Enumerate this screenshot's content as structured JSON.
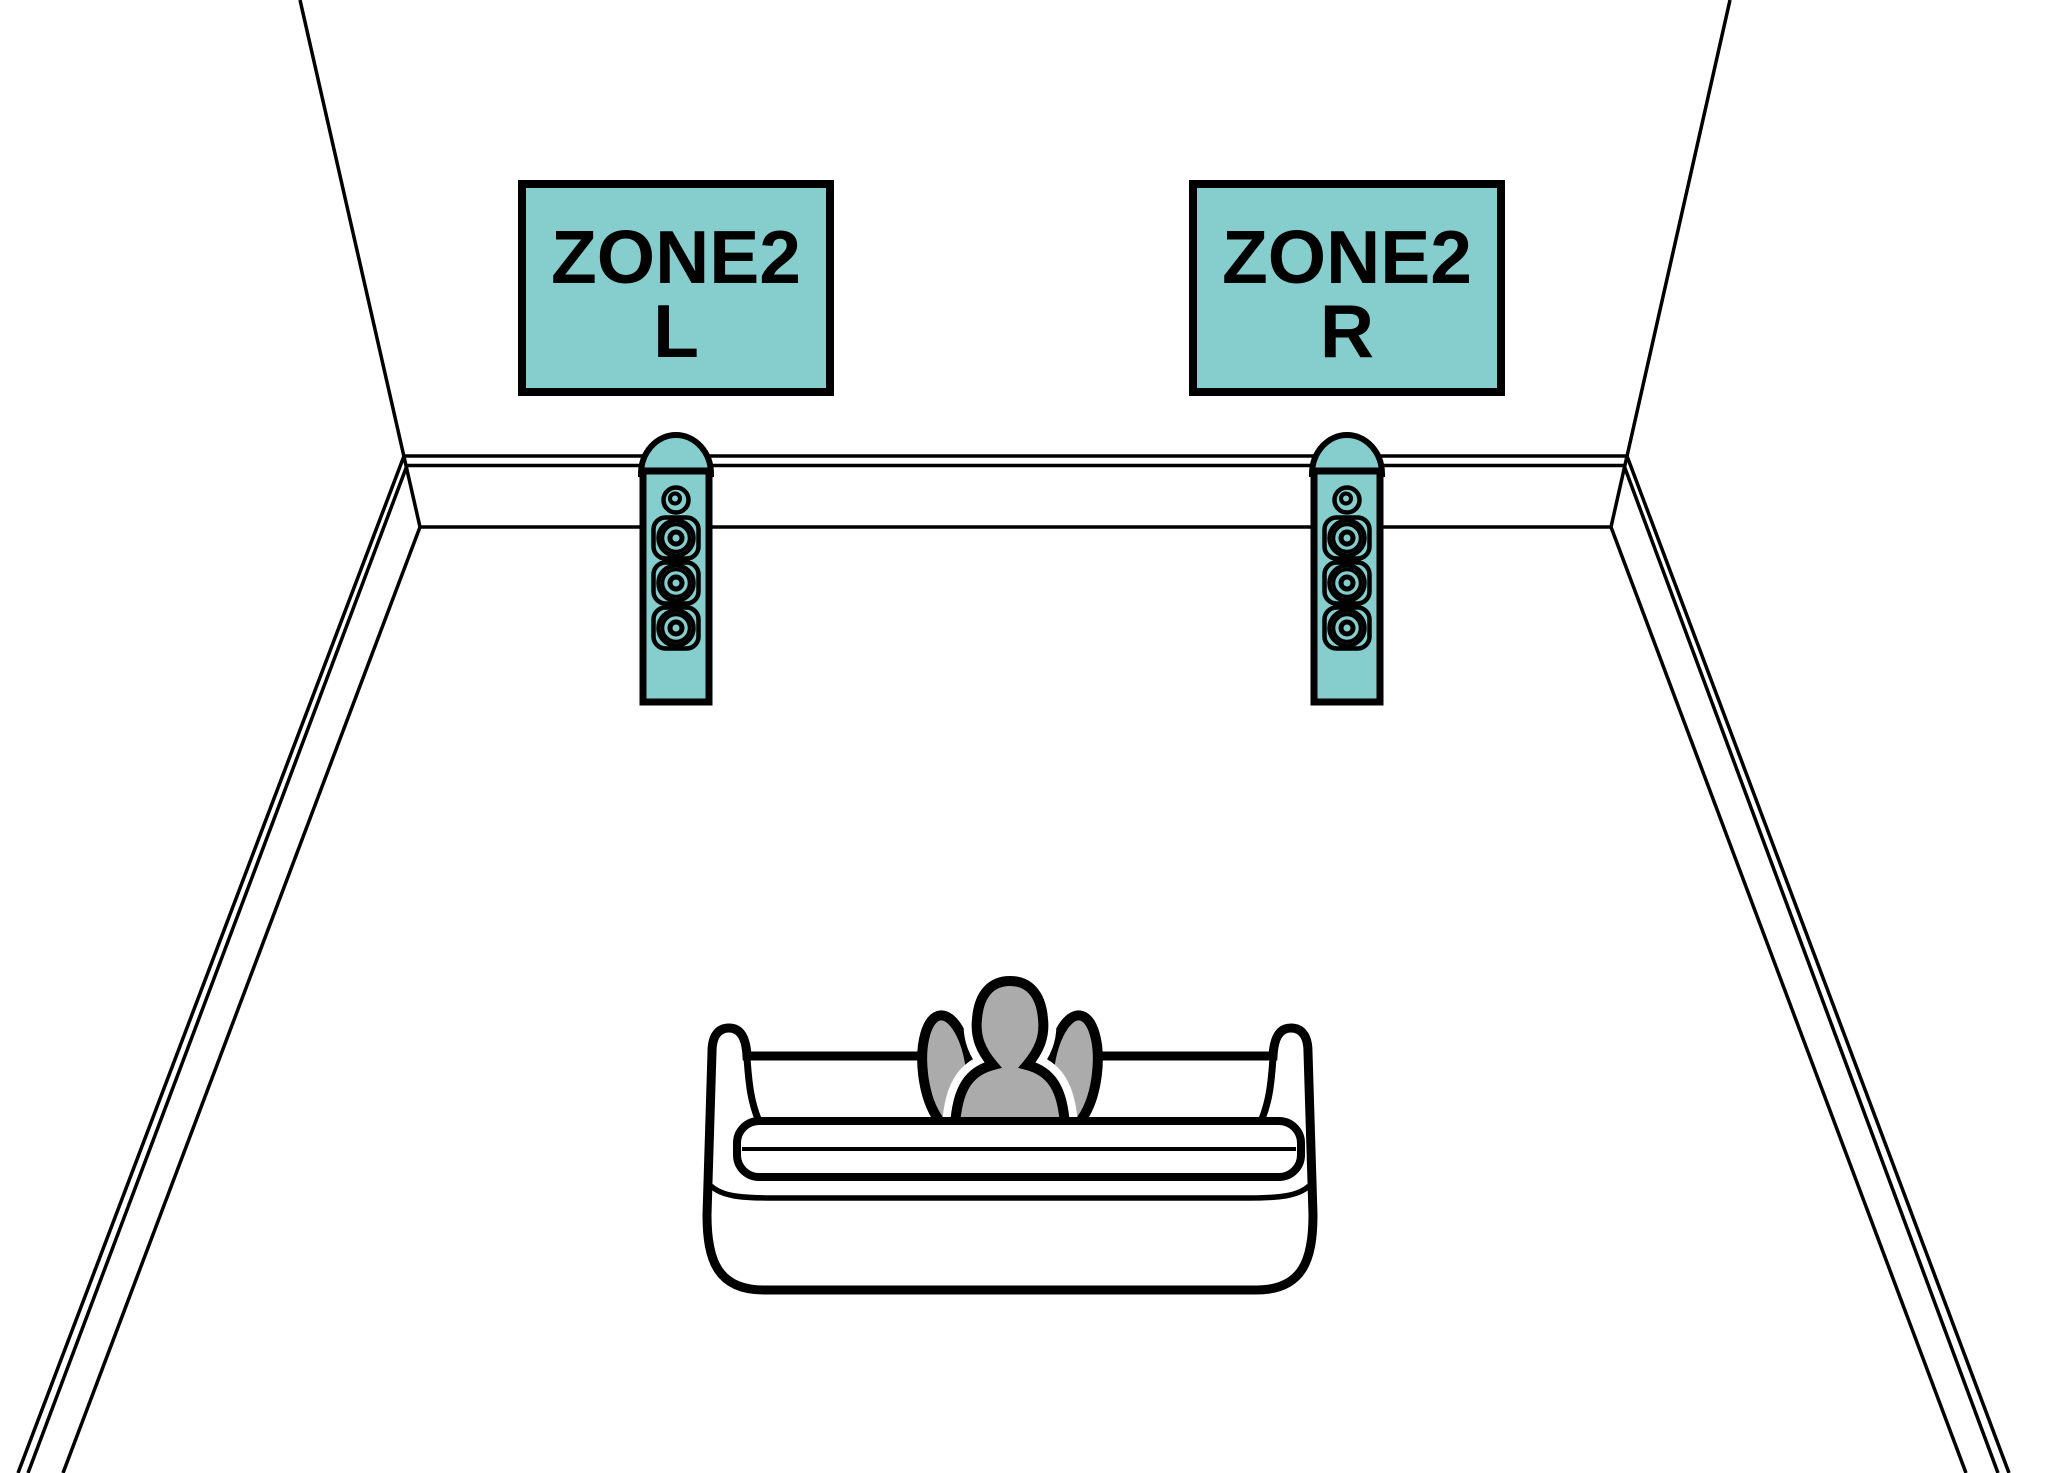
{
  "diagram": {
    "kind": "speaker-placement-room-diagram",
    "labels": {
      "zone2_left": {
        "line1": "ZONE2",
        "line2": "L"
      },
      "zone2_right": {
        "line1": "ZONE2",
        "line2": "R"
      }
    },
    "icons": {
      "left_speaker": "tower-speaker-icon",
      "right_speaker": "tower-speaker-icon",
      "seat": "sofa-icon",
      "listener": "person-listener-icon"
    },
    "colors": {
      "accent_teal": "#85CECD",
      "person_gray": "#ABABAB",
      "outline_black": "#000000",
      "background_white": "#FFFFFF"
    }
  }
}
